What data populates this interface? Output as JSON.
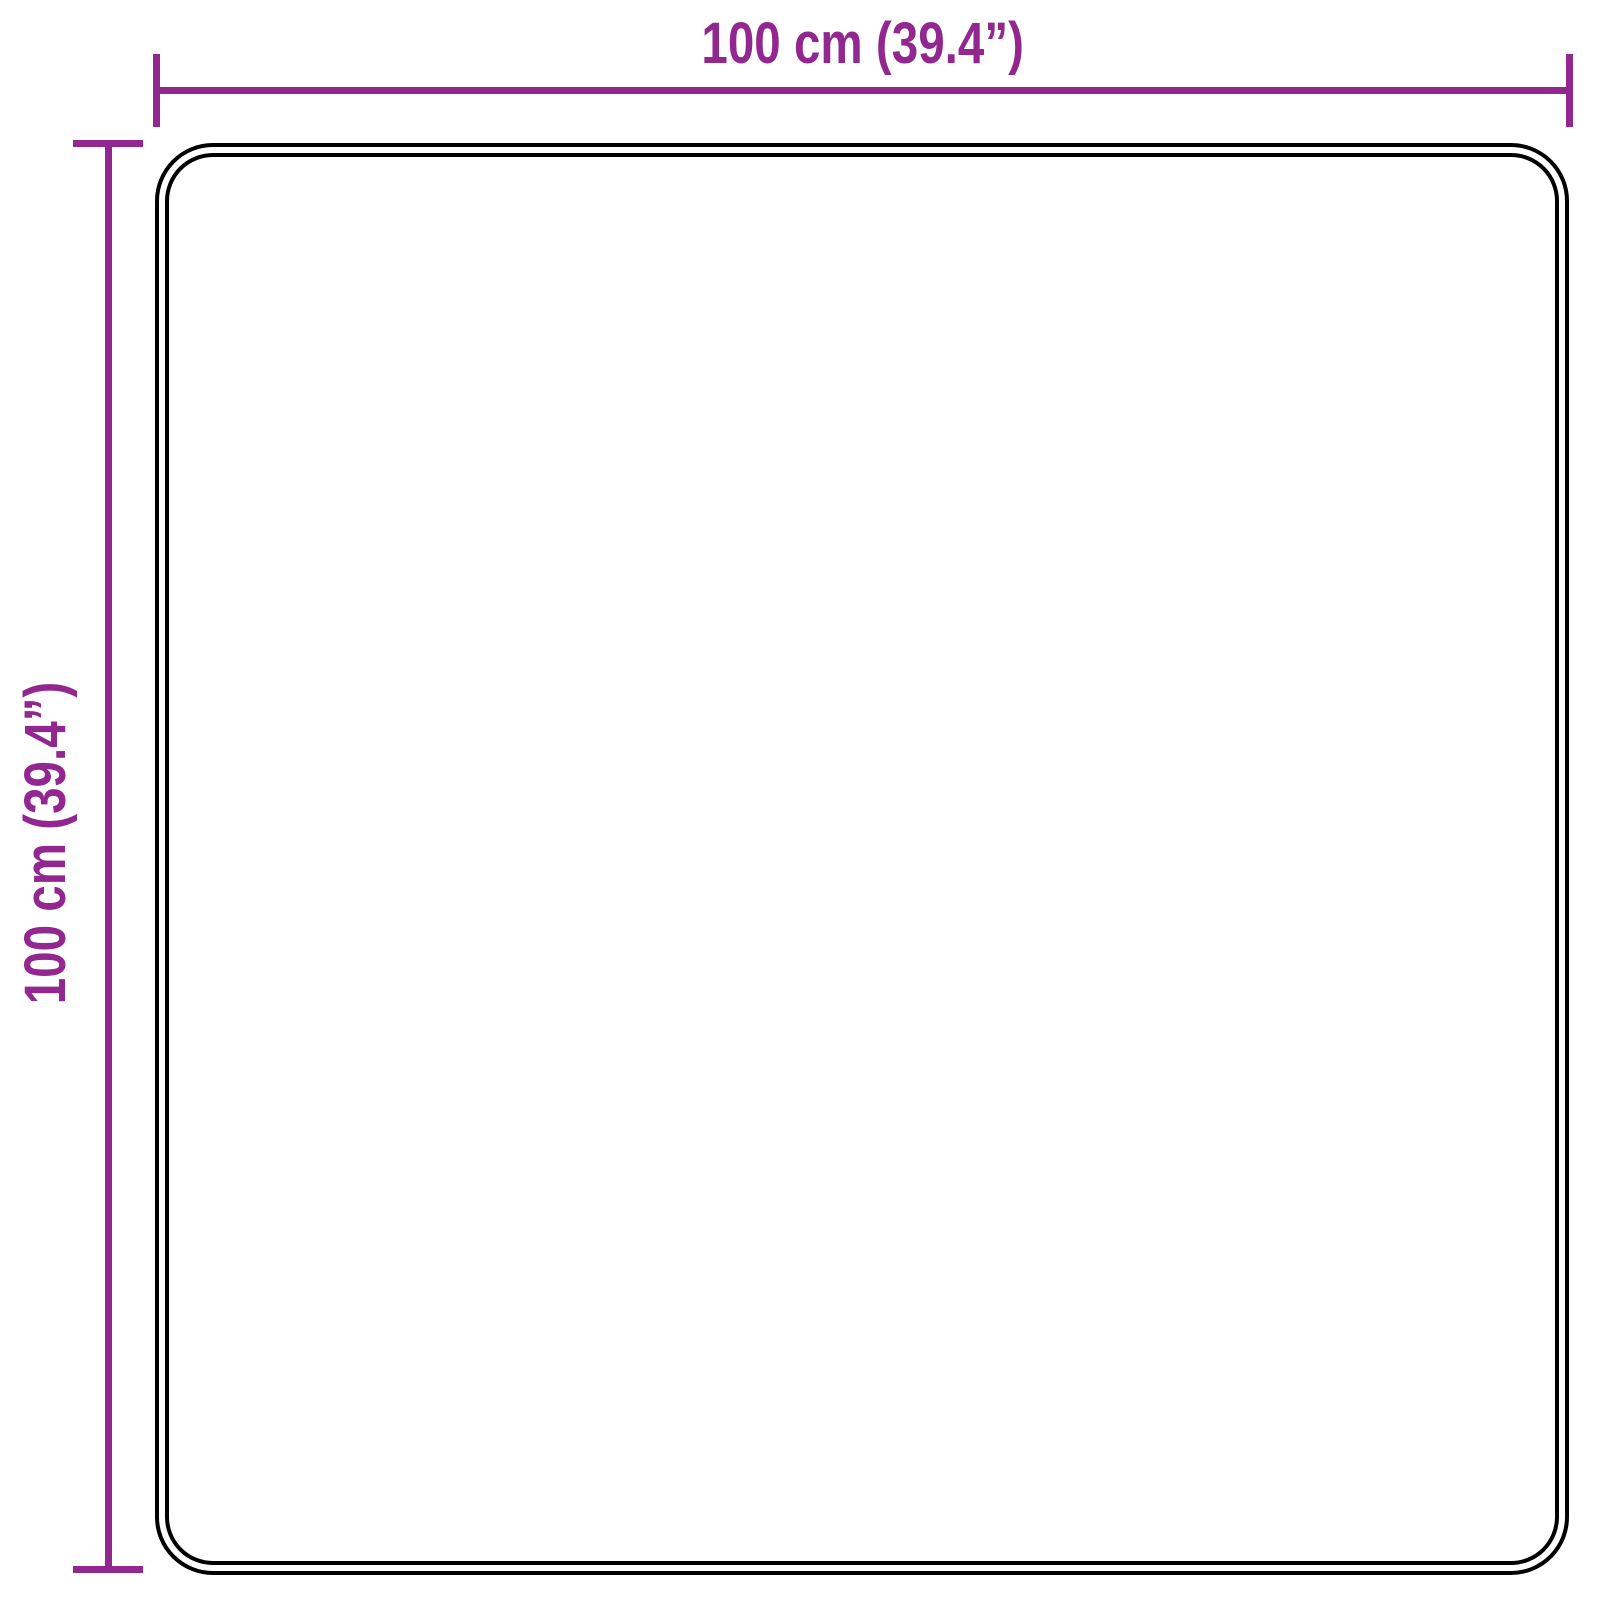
{
  "diagram": {
    "width_label": "100 cm (39.4”)",
    "height_label": "100 cm (39.4”)"
  },
  "colors": {
    "accent": "#92278F",
    "outline": "#000000",
    "background": "#FFFFFF"
  }
}
